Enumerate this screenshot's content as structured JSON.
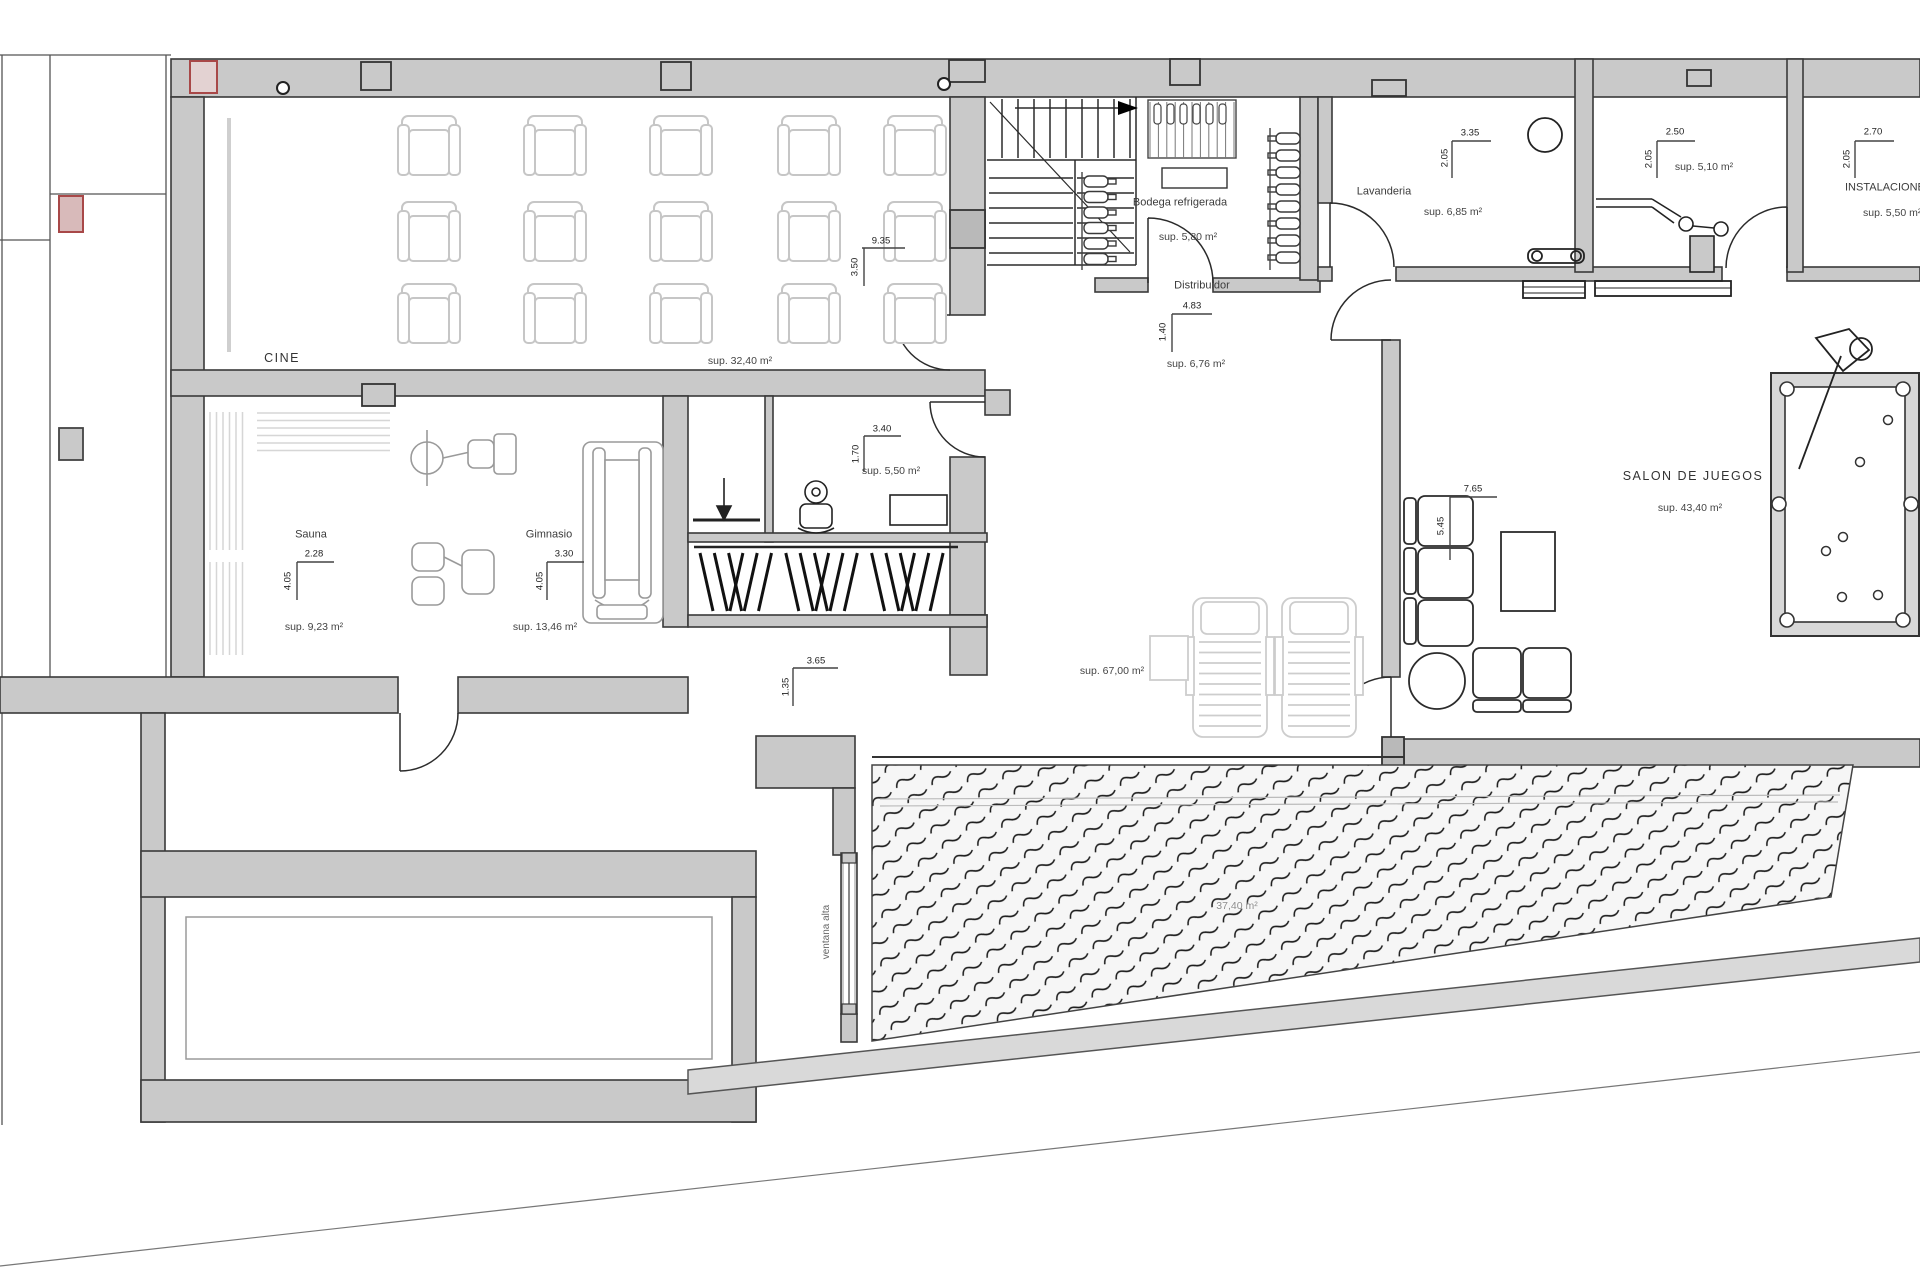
{
  "rooms": {
    "cine": {
      "label": "CINE",
      "area": "sup. 32,40 m²",
      "dim_w": "9.35",
      "dim_h": "3.50"
    },
    "sauna": {
      "label": "Sauna",
      "area": "sup. 9,23 m²",
      "dim_w": "2.28",
      "dim_h": "4.05"
    },
    "gimnasio": {
      "label": "Gimnasio",
      "area": "sup. 13,46 m²",
      "dim_w": "3.30",
      "dim_h": "4.05"
    },
    "bano": {
      "area": "sup. 5,50 m²",
      "dim_w": "3.40",
      "dim_h": "1.70"
    },
    "bodega": {
      "label": "Bodega refrigerada",
      "area": "sup. 5,80 m²"
    },
    "distribuidor": {
      "label": "Distribuidor",
      "area": "sup. 6,76 m²",
      "dim_w": "4.83",
      "dim_h": "1.40"
    },
    "lavanderia": {
      "label": "Lavanderia",
      "area": "sup. 6,85 m²",
      "dim_w": "3.35",
      "dim_h": "2.05"
    },
    "caldera": {
      "area": "sup. 5,10 m²",
      "dim_w": "2.50",
      "dim_h": "2.05"
    },
    "instalaciones": {
      "label": "INSTALACIONES",
      "area": "sup. 5,50 m²",
      "dim_w": "2.70",
      "dim_h": "2.05"
    },
    "salon": {
      "label": "SALON DE JUEGOS",
      "area": "sup. 43,40 m²",
      "dim_w": "7.65",
      "dim_h": "5.45"
    },
    "terraza": {
      "area": "sup. 67,00 m²",
      "dim_w": "3.65",
      "dim_h": "1.35"
    },
    "piscina": {
      "area": "37,40 m²"
    }
  },
  "annotations": {
    "ventana_alta": "ventana alta"
  },
  "colors": {
    "wall_fill": "#c9c9c9",
    "wall_line": "#3a3a3a",
    "column_fill": "#b9b9b9",
    "accent_red": "#a84848",
    "furniture_light": "#c6c6c6",
    "hatch": "#1c1c1c",
    "text": "#3b3b3b"
  }
}
